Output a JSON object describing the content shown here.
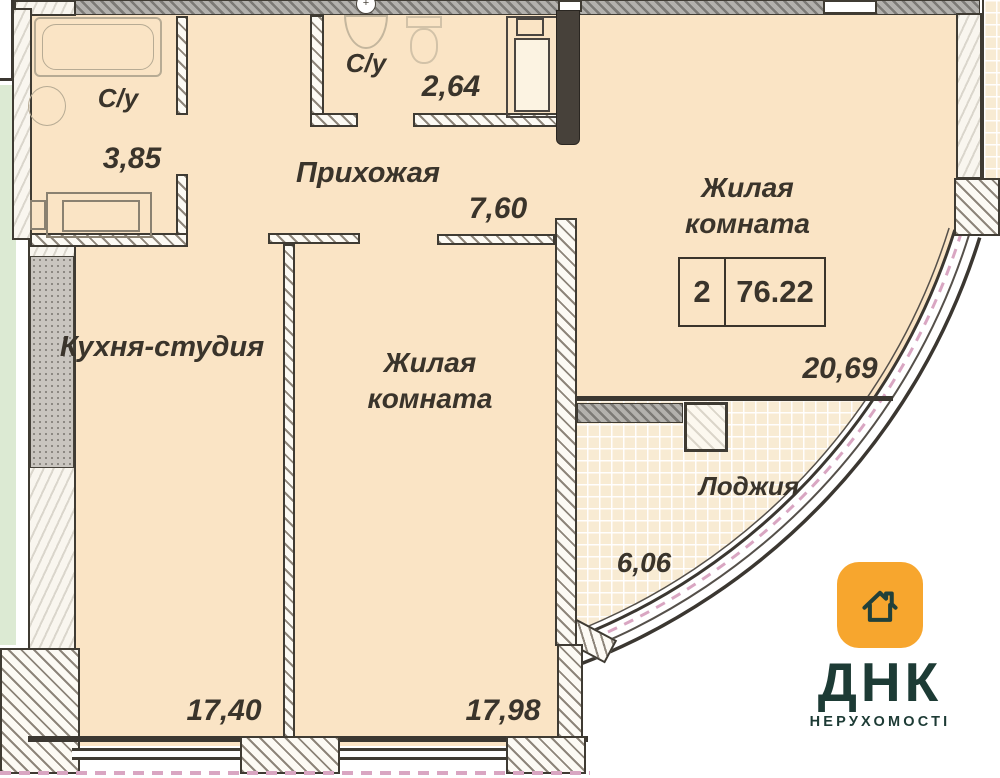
{
  "plan": {
    "rooms": {
      "bathroom1": {
        "label": "С/у",
        "area": "3,85"
      },
      "bathroom2": {
        "label": "С/у",
        "area": "2,64"
      },
      "hallway": {
        "label": "Прихожая",
        "area": "7,60"
      },
      "living_right": {
        "line1": "Жилая",
        "line2": "комната",
        "area": "20,69"
      },
      "kitchen": {
        "label": "Кухня-студия",
        "area": "17,40"
      },
      "living_middle": {
        "line1": "Жилая",
        "line2": "комната",
        "area": "17,98"
      },
      "loggia": {
        "label": "Лоджия",
        "area": "6,06"
      }
    },
    "summary": {
      "rooms_count": "2",
      "total_area": "76.22"
    },
    "fixtures": [
      "bathtub",
      "sink",
      "washing-machine",
      "toilet",
      "cabinet"
    ],
    "marker": "+"
  },
  "logo": {
    "title": "ДНК",
    "subtitle": "НЕРУХОМОСТІ"
  },
  "colors": {
    "floor_beige": "#fae4c5",
    "loggia_grid": "#f8ebd3",
    "wall_gray": "#b3b1ad",
    "outside_green": "#dcead3",
    "axis_pink": "#d9a6c2",
    "logo_orange": "#f7a62e",
    "logo_text": "#1d3b35",
    "line_dark": "#3f3b33"
  }
}
